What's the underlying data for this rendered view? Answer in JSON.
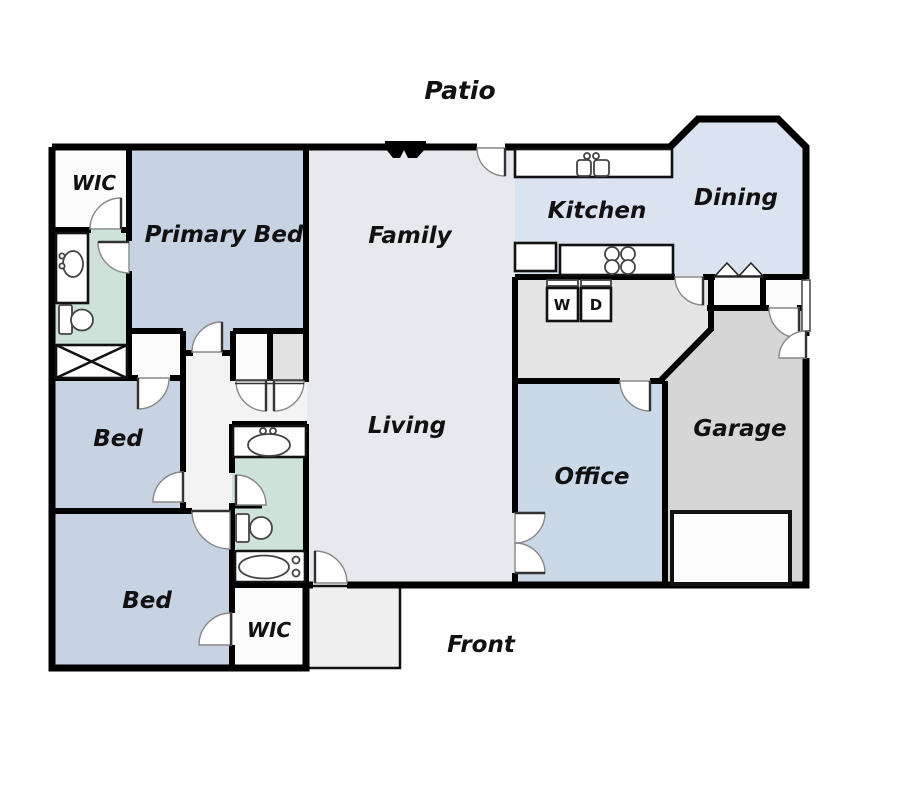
{
  "labels": {
    "patio": "Patio",
    "family": "Family",
    "living": "Living",
    "kitchen": "Kitchen",
    "dining": "Dining",
    "primary_bed": "Primary Bed",
    "bed_upper": "Bed",
    "bed_lower": "Bed",
    "office": "Office",
    "garage": "Garage",
    "front": "Front",
    "wic_upper": "WIC",
    "wic_lower": "WIC",
    "washer": "W",
    "dryer": "D"
  },
  "palette": {
    "wall": "#000000",
    "bed": "#c7d2e2",
    "office": "#cbd8e8",
    "kitchen": "#dbe3f1",
    "living": "#e7e9ee",
    "bath": "#cde2d9",
    "laundry": "#e5e5e5",
    "garage": "#d6d6d6",
    "closetgray": "#e1e1e1",
    "whiteroom": "#fbfbfb",
    "hall": "#f3f3f4",
    "porch": "#efefef"
  }
}
